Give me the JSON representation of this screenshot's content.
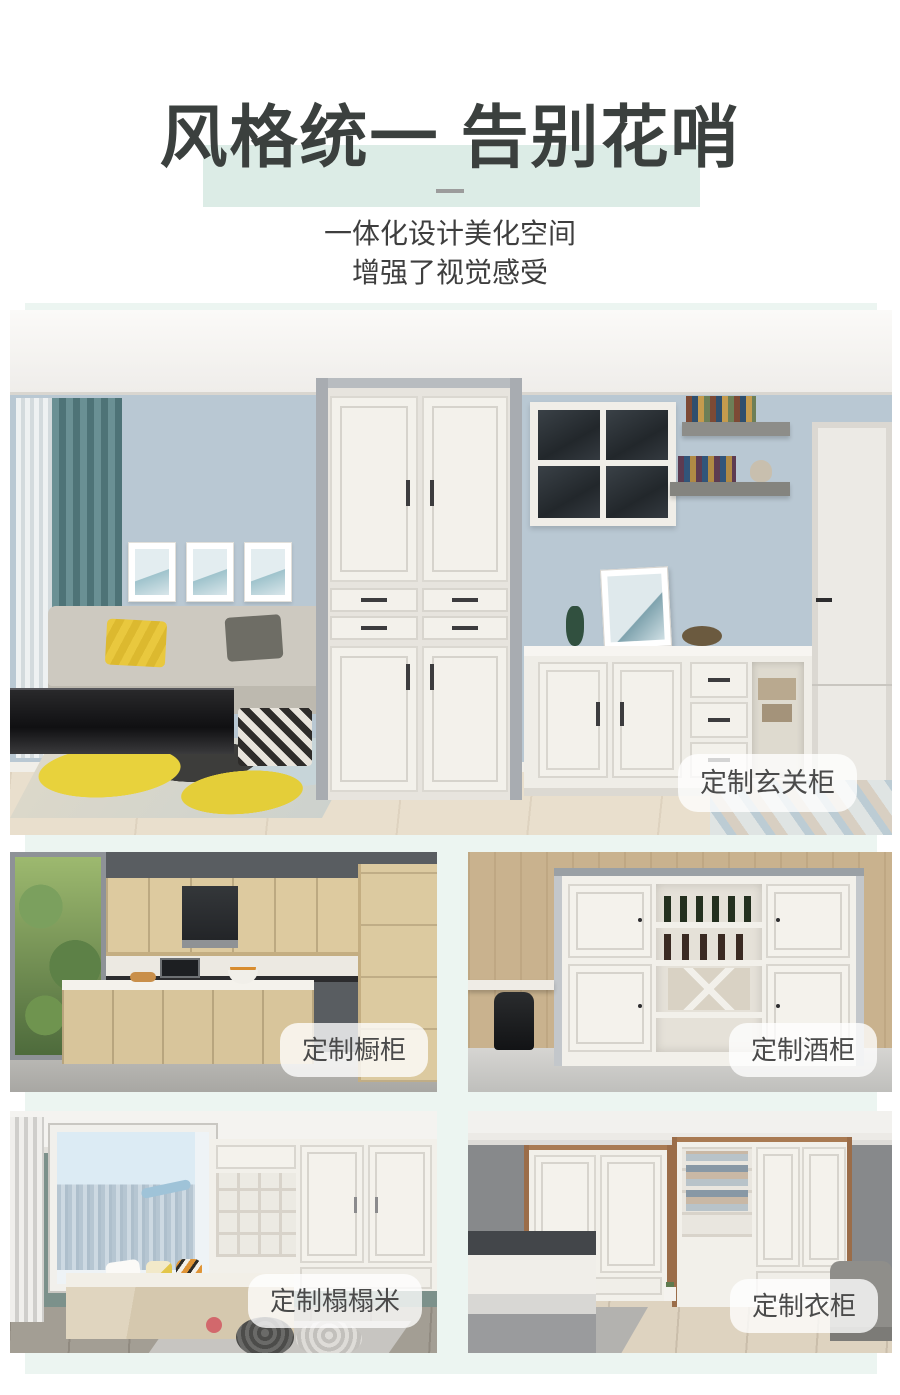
{
  "theme": {
    "page_bg": "#ffffff",
    "mint_panel": "#ecf5f1",
    "title_highlight": "#dcece6",
    "title_color": "#3b403e",
    "subtitle_color": "#3e3e3e",
    "divider_color": "#9c9c9c",
    "label_bg": "rgba(255,255,255,0.78)",
    "label_color": "#4a4a4a"
  },
  "header": {
    "title": "风格统一 告别花哨",
    "subtitle_line1": "一体化设计美化空间",
    "subtitle_line2": "增强了视觉感受"
  },
  "gallery": {
    "hero": {
      "label": "定制玄关柜",
      "photo": "living-room-entryway-cabinet"
    },
    "items": [
      {
        "label": "定制橱柜",
        "photo": "kitchen-cabinets"
      },
      {
        "label": "定制酒柜",
        "photo": "wine-cabinet"
      },
      {
        "label": "定制榻榻米",
        "photo": "tatami-room"
      },
      {
        "label": "定制衣柜",
        "photo": "corner-wardrobe"
      }
    ]
  }
}
